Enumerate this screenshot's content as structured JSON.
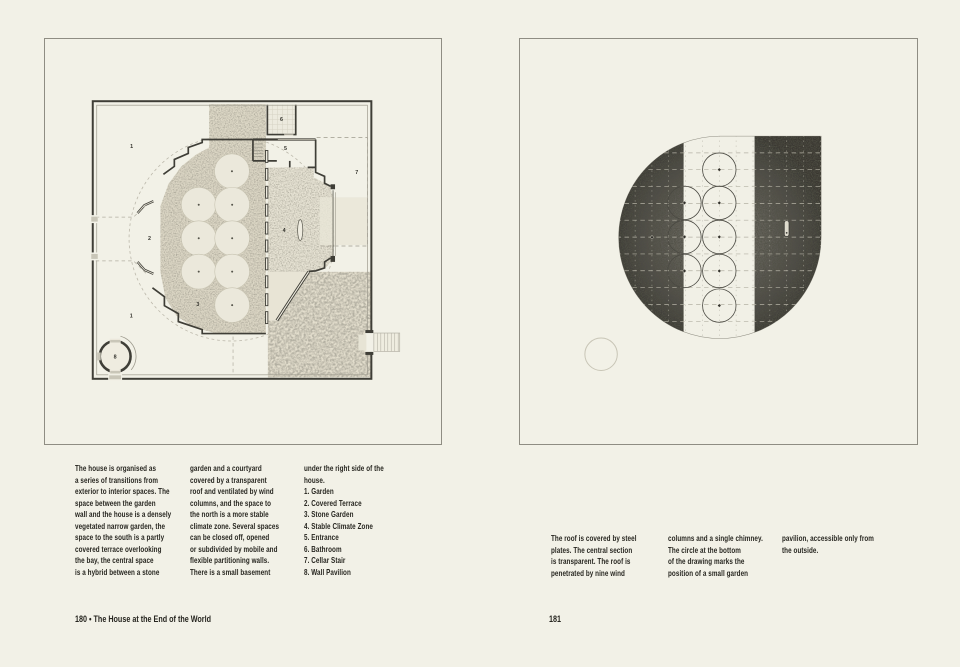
{
  "colors": {
    "paper": "#f2f1e7",
    "ink": "#26251f",
    "wall": "#3f3e37",
    "frame": "#8f8d83",
    "roof-dark": "#3a3933",
    "roof-mid": "#6e6c63"
  },
  "left_page": {
    "plan": {
      "labels": [
        {
          "text": "1"
        },
        {
          "text": "2"
        },
        {
          "text": "3"
        },
        {
          "text": "4"
        },
        {
          "text": "5"
        },
        {
          "text": "6"
        },
        {
          "text": "7"
        },
        {
          "text": "8"
        },
        {
          "text": "1"
        }
      ]
    },
    "columns": [
      {
        "lines": [
          "The house is organised as",
          "a series of transitions from",
          "exterior to interior spaces. The",
          "space between the garden",
          "wall and the house is a densely",
          "vegetated narrow garden, the",
          "space to the south is a partly",
          "covered terrace overlooking",
          "the bay, the central space",
          "is a hybrid between a stone"
        ]
      },
      {
        "lines": [
          "garden and a courtyard",
          "covered by a transparent",
          "roof and ventilated by wind",
          "columns, and the space to",
          "the north is a more stable",
          "climate zone. Several spaces",
          "can be closed off, opened",
          "or subdivided by mobile and",
          "flexible partitioning walls.",
          "There is a small basement"
        ]
      },
      {
        "lines": [
          "under the right side of the",
          "house.",
          "1. Garden",
          "2. Covered Terrace",
          "3. Stone Garden",
          "4. Stable Climate Zone",
          "5. Entrance",
          "6. Bathroom",
          "7. Cellar Stair",
          "8. Wall Pavilion"
        ]
      }
    ],
    "footer": "180 • The House at the End of the World"
  },
  "right_page": {
    "columns": [
      {
        "lines": [
          "The roof is covered by steel",
          "plates. The central section",
          "is transparent. The roof is",
          "penetrated by nine wind"
        ]
      },
      {
        "lines": [
          "columns and a single chimney.",
          "The circle at the bottom",
          "of the drawing marks the",
          "position of a small garden"
        ]
      },
      {
        "lines": [
          "pavilion, accessible only from",
          "the outside."
        ]
      }
    ],
    "footer": "181"
  }
}
